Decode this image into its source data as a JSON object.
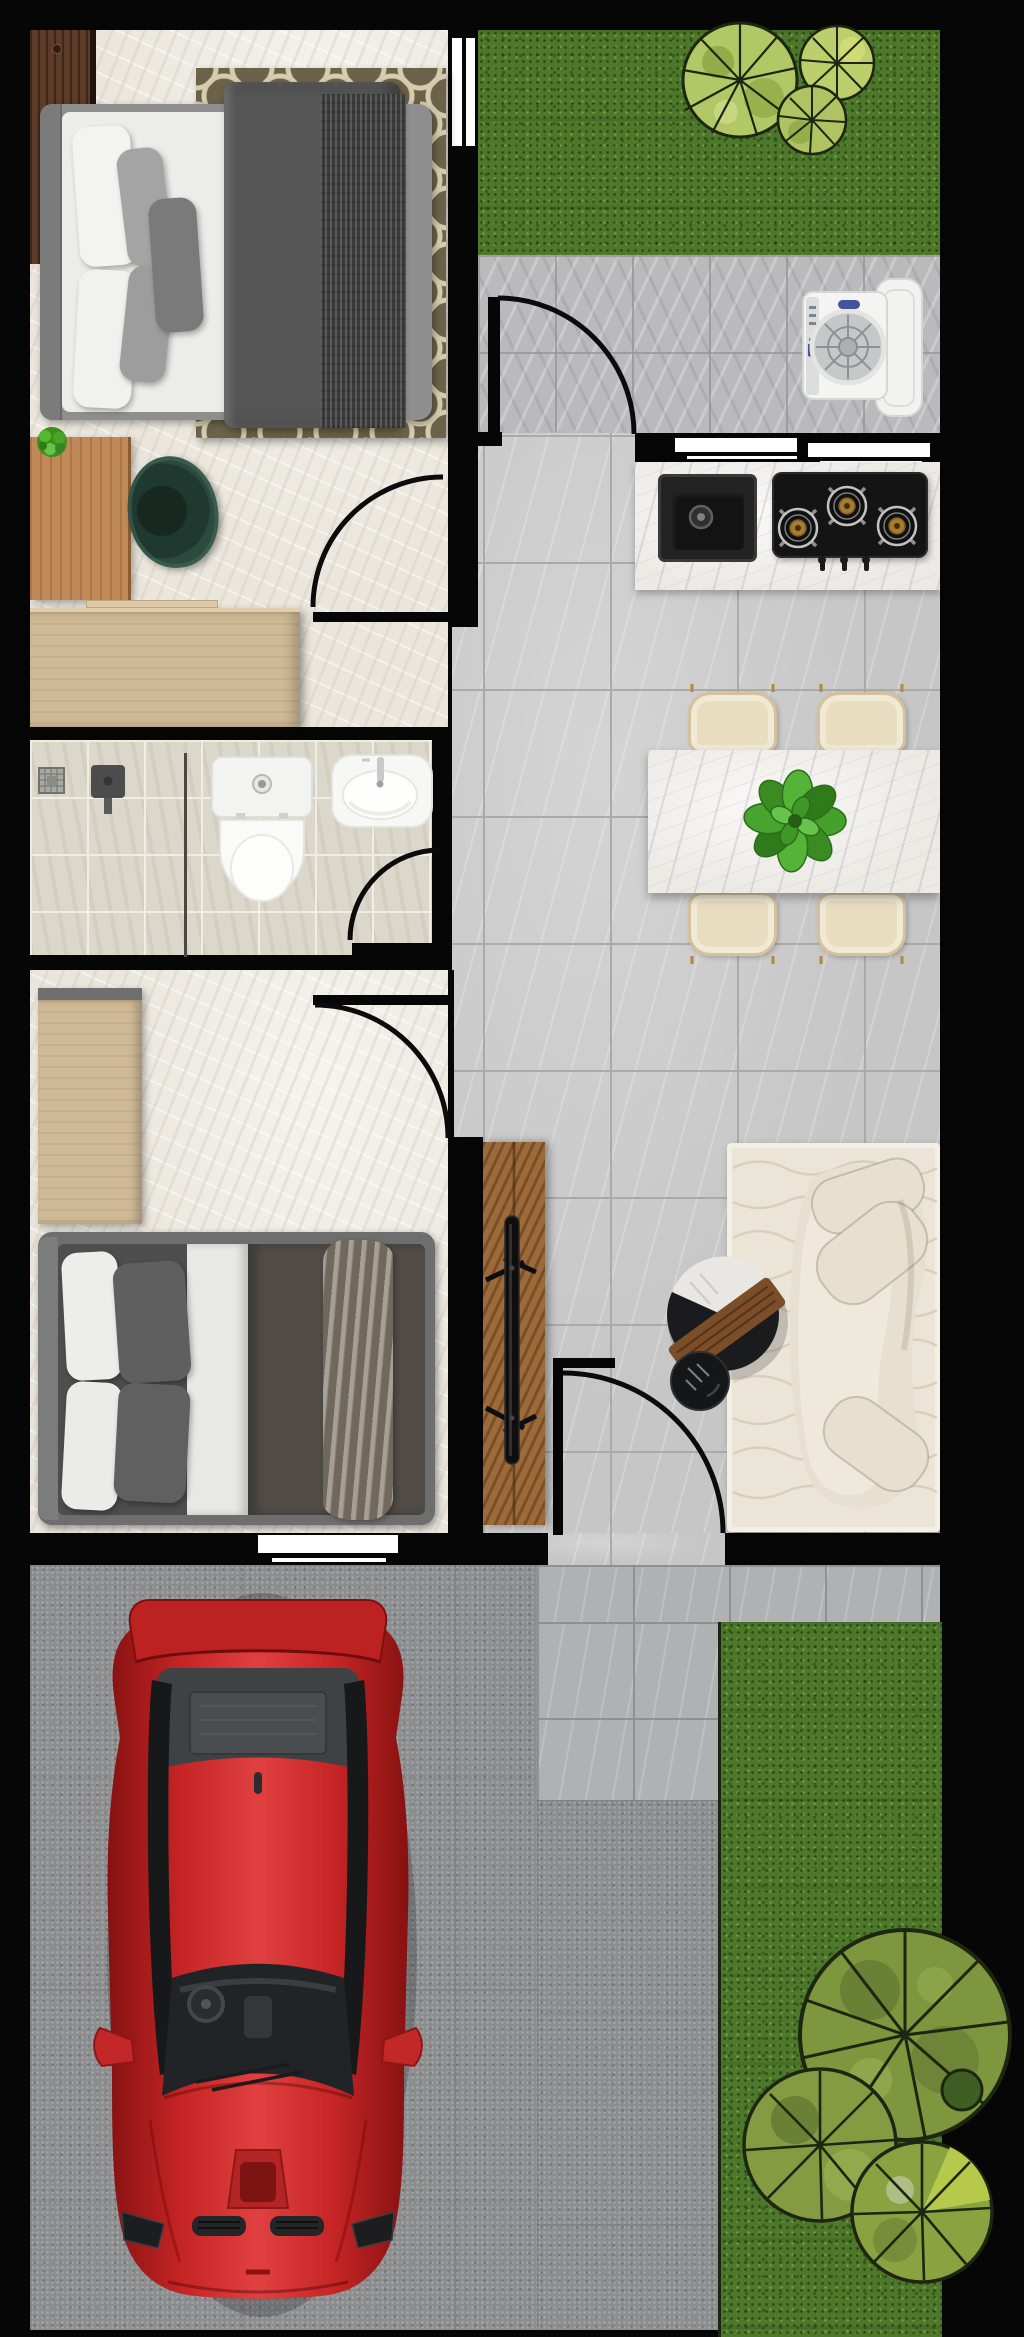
{
  "title": "apartment-floor-plan-top-view",
  "palette": {
    "wall": "#060606",
    "plaster": "#eae6dd",
    "tileMain": "#c6c6c6",
    "tileGrout": "#aaaaaa",
    "tileBath": "#dcd7cb",
    "groutBath": "#f0ede5",
    "patio": "#bababc",
    "walkway": "#b0b1b3",
    "concrete": "#8b8d8f",
    "grass": "#4d772a",
    "treeLight": "#b2c766",
    "treeLightPatch": "#94ab49",
    "treeOlive": "#7e963e",
    "treeOlivePatch": "#6a8034",
    "treeOutline": "#1d2610",
    "treeDark": "#3f5e24",
    "marble": "#eceae5",
    "rugOlive": "#6c6249",
    "rugCream": "#d6cdaf",
    "rugLiving": "#ebe5d7",
    "rugLine": "#d9cfba",
    "sofa": "#e7e0d1",
    "sofaSeat": "#efe9dc",
    "cushion": "#e8e0cf",
    "cream": "#e9ddc0",
    "walnut": "#5d3b28",
    "oak": "#c08a58",
    "tan": "#cfb996",
    "woodTv": "#9d6a3a",
    "woodSlab": "#7b4e2a",
    "chairGreen": "#2c4a3e",
    "fabricDark": "#565656",
    "duvet2": "#514c47",
    "throw2": "#8d8478",
    "white": "#ffffff",
    "porcelain": "#f6f6f4",
    "carRed": "#c62525",
    "carDarkRed": "#861111",
    "glass": "#1c1e20",
    "steel": "#c2c2c3",
    "brass": "#a57c30",
    "washerBlue": "#44549a",
    "plantGreen": "#46a02c"
  },
  "inventory": {
    "rooms": [
      {
        "id": "bedroom-1",
        "furniture": [
          "double-bed",
          "pillows",
          "duvet",
          "throw-blanket",
          "trellis-rug",
          "walnut-wardrobe",
          "oak-desk",
          "desk-plant",
          "green-chair",
          "tan-dresser"
        ]
      },
      {
        "id": "bathroom",
        "furniture": [
          "shower-area",
          "floor-drain",
          "shower-mixer",
          "glass-divider",
          "toilet",
          "wash-basin"
        ]
      },
      {
        "id": "bedroom-2",
        "furniture": [
          "tan-wardrobe",
          "double-bed",
          "pillows",
          "duvet",
          "throw-blanket"
        ]
      },
      {
        "id": "kitchen",
        "furniture": [
          "marble-counter",
          "black-sink",
          "three-burner-gas-hob",
          "window-band"
        ]
      },
      {
        "id": "dining-area",
        "furniture": [
          "marble-dining-table",
          "four-cream-chairs",
          "leafy-centerpiece-plant"
        ]
      },
      {
        "id": "living-area",
        "furniture": [
          "curved-cream-sofa",
          "wavy-area-rug",
          "round-coffee-table",
          "wood-slab",
          "round-side-table",
          "tv-wall-panel",
          "flat-tv"
        ]
      },
      {
        "id": "laundry-patio",
        "furniture": [
          "top-load-washing-machine"
        ]
      },
      {
        "id": "garden-top",
        "furniture": [
          "lawn",
          "three-light-green-trees"
        ]
      },
      {
        "id": "garden-right",
        "furniture": [
          "lawn",
          "three-olive-trees"
        ]
      },
      {
        "id": "garage-driveway",
        "furniture": [
          "red-sports-car",
          "concrete-slab",
          "tile-walkway"
        ]
      }
    ],
    "doors": [
      "entry-door",
      "bedroom-1-door",
      "bathroom-door",
      "bedroom-2-door",
      "garage-door"
    ],
    "windows": [
      "bedroom-1-window",
      "kitchen-window-left",
      "kitchen-window-right",
      "bedroom-2-window"
    ]
  }
}
